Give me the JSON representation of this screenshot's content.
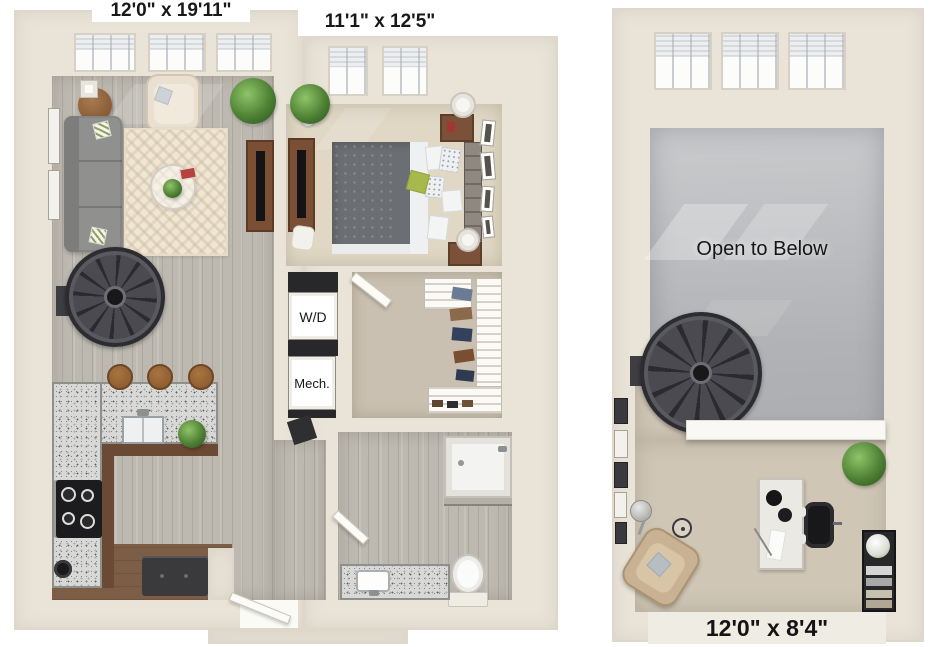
{
  "left_unit": {
    "living_dining_dim": "12'0\" x 19'11\"",
    "bedroom_dim": "11'1\" x 12'5\"",
    "washer_dryer_label": "W/D",
    "mechanical_label": "Mech."
  },
  "right_unit": {
    "open_to_below_label": "Open to Below",
    "loft_dim": "12'0\" x 8'4\""
  },
  "palette": {
    "page_background": "#ffffff",
    "wall_cream": "#e9e3d8",
    "wood_floor": "#bdb9b1",
    "bedroom_carpet": "#e0d7c5",
    "loft_carpet": "#cfc6b5",
    "open_to_below_gray": "#b4b6b9",
    "kitchen_brown": "#7c5d46",
    "granite": "#d8d8d6",
    "stair_charcoal": "#3a3a40",
    "label_text": "#181818"
  }
}
